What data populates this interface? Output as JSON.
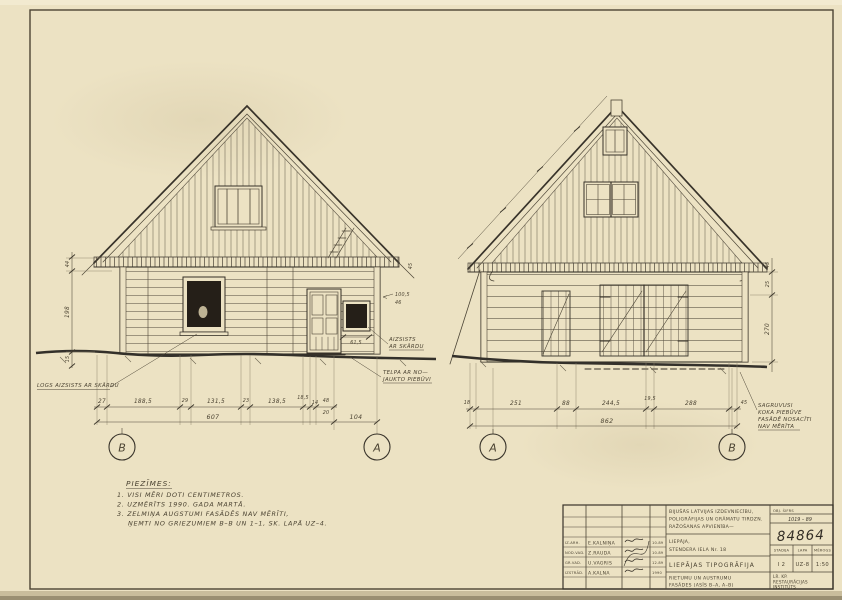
{
  "notes": {
    "title": "PIEZĪMES:",
    "lines": [
      "1. VISI MĒRI DOTI CENTIMETROS.",
      "2. UZMĒRĪTS 1990. GADA MARTĀ.",
      "3. ZELMIŅA AUGSTUMI FASĀDĒS NAV MĒRĪTI,",
      "ŅEMTI NO GRIEZUMIEM B–B UN 1–1, SK. LAPĀ UZ–4."
    ]
  },
  "callouts": {
    "window_tin": "LOGS AIZSISTS AR SKĀRDU",
    "tin1": "AIZSISTS",
    "tin2": "AR SKĀRDU",
    "room1": "TELPA AR NO—",
    "room2": "JAUKTO PIEBŪVI",
    "annex1": "SAGRUVUSI",
    "annex2": "KOKA PIEBŪVE",
    "annex3": "FASĀDĒ NOSACĪTI",
    "annex4": "NAV MĒRĪTA"
  },
  "axes": {
    "lb": "B",
    "la": "A",
    "ra": "A",
    "rb": "B"
  },
  "dims": {
    "left_bottom": [
      "27",
      "188,5",
      "29",
      "131,5",
      "23",
      "138,5",
      "18,5",
      "14",
      "48"
    ],
    "left_stack": "20",
    "left_total": "607",
    "left_offset": "104",
    "right_bottom": [
      "18",
      "251",
      "88",
      "244,5",
      "19,5",
      "288",
      "45"
    ],
    "right_total": "862",
    "left_vert": [
      "44",
      "198",
      "15"
    ],
    "right_vert": [
      "25",
      "270"
    ],
    "misc": {
      "a": "45",
      "b": "100,5",
      "c": "46",
      "d": "61,5",
      "e": "45"
    }
  },
  "titleblock": {
    "org": [
      "BIJUŠĀS LATVIJAS IZDEVNIECĪBU,",
      "POLIGRĀFIJAS UN GRĀMATU TIRDZN.",
      "RAŽOŠANAS APVIENĪBA—"
    ],
    "obj_code_label": "OBJ. ŠIFRS",
    "obj_code": "1019 – 89",
    "address": [
      "LIEPĀJA,",
      "STENDERA IELA Nr. 18"
    ],
    "number": "84864",
    "building": "LIEPĀJAS TIPOGRĀFIJA",
    "stadija_label": "STADIJA",
    "lapa_label": "LAPA",
    "merogs_label": "MĒROGS",
    "stadija": "I 2",
    "lapa": "UZ-8",
    "merogs": "1:50",
    "sheet_title": [
      "RIETUMU UN AUSTRUMU",
      "FASĀDES (ASĪS B–A, A–B)"
    ],
    "institute": [
      "LR. KP.",
      "RESTAURĀCIJAS",
      "INSTITŪTS"
    ],
    "rows": [
      {
        "role": "IZ.ARH.",
        "name": "E.KALNIŅA",
        "date": "10.89"
      },
      {
        "role": "NOD.VAD.",
        "name": "Z.RAUDA",
        "date": "10.89"
      },
      {
        "role": "GR.VAD.",
        "name": "U.VAGRIS",
        "date": "12.89"
      },
      {
        "role": "IZSTRĀD.",
        "name": "A.KALNA",
        "date": "1990"
      }
    ]
  }
}
